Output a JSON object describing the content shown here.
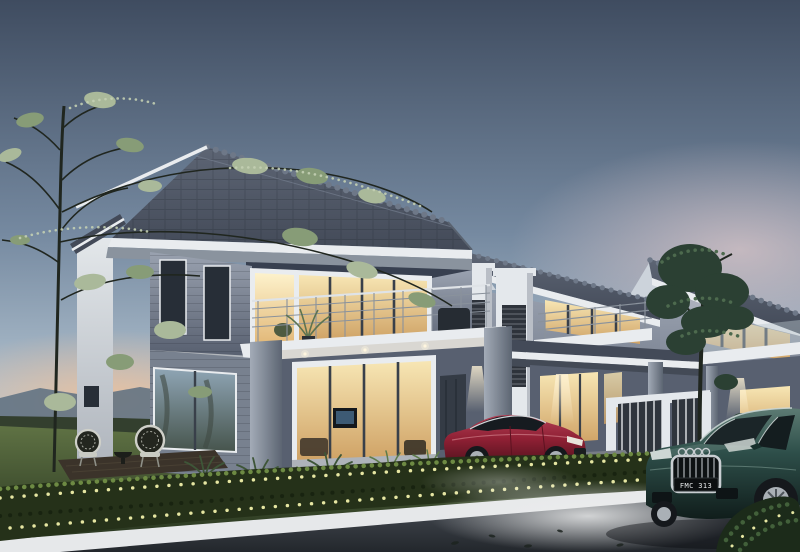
{
  "scene": {
    "title": "Modern two-storey terrace houses at dusk",
    "description": "3D architectural render of a row of grey-and-white modern double-storey terrace homes at twilight: warm lit interiors, balconies with steel railings, landscaped lawn with two wicker chairs and a slender tree, a trimmed flowering hedge along the street edge, a maroon coupe parked in a driveway and a dark-teal coupe with a four-ring badge on the road.",
    "time_of_day": "dusk",
    "house_count_visible": 4,
    "storeys": 2
  },
  "vehicles": {
    "teal_car": {
      "type": "coupe",
      "color_name": "dark teal",
      "license_plate": "FMC 313",
      "badge": "four-rings"
    },
    "red_car": {
      "type": "coupe",
      "color_name": "maroon red"
    }
  },
  "palette": {
    "sky_top": "#3f4c60",
    "sky_mid": "#7589a0",
    "sky_low": "#aebfcd",
    "sky_horizon": "#d8dde1",
    "pink_haze": "#dcc6c8",
    "sunset_glow": "#eec09a",
    "mountain": "#5c6e80",
    "treeline": "#333f2e",
    "roof_dark": "#434a58",
    "roof_light": "#5d6574",
    "roof_ridge": "#6e7888",
    "white_trim": "#e9ecef",
    "soffit": "#8a939e",
    "accent_band": "#384050",
    "gable_light": "#ccd3db",
    "wall_light": "#9aa2b0",
    "wall_mid": "#78818f",
    "wall_dark": "#586070",
    "wall_white": "#e4e8ec",
    "frame_dark": "#39404a",
    "glass_dark": "#272e37",
    "glass_cool": "#8fa5b5",
    "window_warm": "#f2dda6",
    "window_amber": "#cfa265",
    "rail_light": "#dfe3e7",
    "rail_dark": "#8a929c",
    "pillar_light": "#a3abb7",
    "pillar_dark": "#5c6572",
    "grass_light": "#5f7244",
    "grass_dark": "#26331e",
    "hedge_dark": "#253119",
    "hedge_light": "#6d8a43",
    "flower_yellow": "#e6e6a2",
    "deck_brown": "#3b332a",
    "wicker": "#cfd0c9",
    "trunk": "#20261f",
    "leaf_pale": "#aab99a",
    "leaf_mid": "#879c77",
    "big_tree": "#2b4033",
    "big_tree_hi": "#4d6a4e",
    "road_light": "#5a6067",
    "road_dark": "#23272c",
    "curb_white": "#e6e8ea",
    "car_red": "#8f2034",
    "car_red_hi": "#b34055",
    "car_teal": "#2e4f4a",
    "car_teal_hi": "#5d7b73",
    "chrome": "#c9ced2",
    "tire": "#15181c",
    "rim_silver": "#aab0b6",
    "shadow": "#0b0e12",
    "plate_black": "#0c0e10",
    "plate_text": "#e8eaec"
  }
}
